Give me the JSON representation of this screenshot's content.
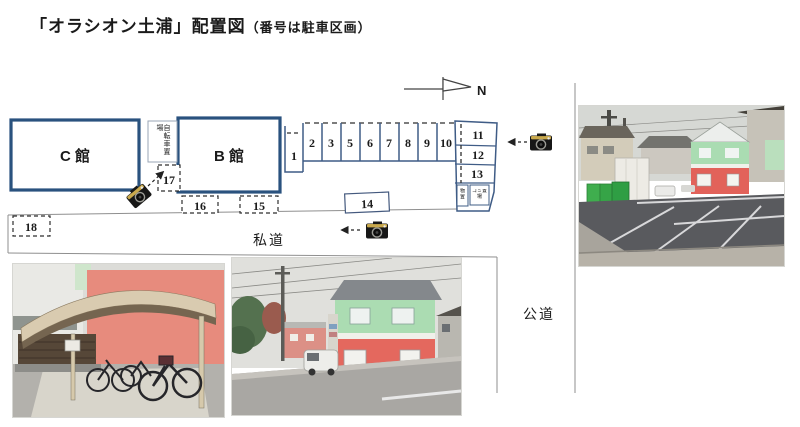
{
  "title": {
    "main": "「オラシオン土浦」配置図",
    "note": "（番号は駐車区画）"
  },
  "plan": {
    "building_c_label": "C 館",
    "building_b_label": "B 館",
    "bicycle_parking_label": "自転車置場",
    "north_label": "N",
    "private_road_label": "私道",
    "public_road_label": "公道",
    "storage_label": "物置",
    "garbage_label": "ゴミ置場",
    "space_labels": [
      "1",
      "2",
      "3",
      "5",
      "6",
      "7",
      "8",
      "9",
      "10",
      "11",
      "12",
      "13",
      "14",
      "15",
      "16",
      "17",
      "18"
    ]
  },
  "icons": {
    "camera": "camera-icon",
    "north_arrow": "north-arrow-icon"
  },
  "colors": {
    "building_border": "#2a527e",
    "parking_line": "#3f5c86",
    "dash_line": "#2e2e2e",
    "road_line": "#8f8f8f"
  }
}
